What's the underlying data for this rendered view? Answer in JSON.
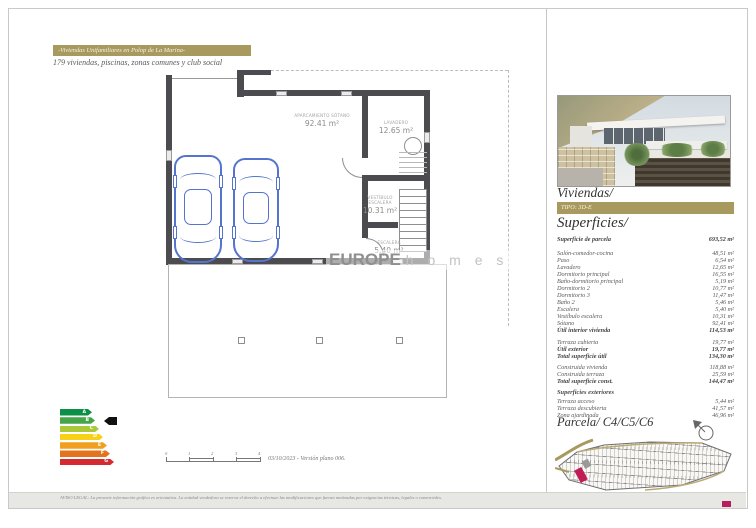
{
  "header": {
    "banner": "-Viviendas Unifamiliares en Polop de La Marina-",
    "subtitle": "179 viviendas, piscinas, zonas comunes y club social"
  },
  "plan": {
    "rooms": [
      {
        "name": "APARCAMIENTO SÓTANO",
        "area": "92.41 m²"
      },
      {
        "name": "LAVADERO",
        "area": "12.65 m²"
      },
      {
        "name": "VESTÍBULO ESCALERA",
        "area": "10.31 m²"
      },
      {
        "name": "ESCALERA",
        "area": "5.40 m²"
      }
    ],
    "watermark_bold": "EUROPE",
    "watermark_light": "h o m e s"
  },
  "panel": {
    "title": "Viviendas/",
    "tipo": "TIPO: 3D-E",
    "superficies_title": "Superficies/",
    "rows": [
      {
        "label": "Superficie de parcela",
        "value": "693,52 m²"
      },
      {
        "label": "Salón-comedor-cocina",
        "value": "48,51 m²"
      },
      {
        "label": "Paso",
        "value": "6,54 m²"
      },
      {
        "label": "Lavadero",
        "value": "12,65 m²"
      },
      {
        "label": "Dormitorio principal",
        "value": "16,55 m²"
      },
      {
        "label": "Baño-dormitorio principal",
        "value": "5,19 m²"
      },
      {
        "label": "Dormitorio 2",
        "value": "10,77 m²"
      },
      {
        "label": "Dormitorio 3",
        "value": "11,47 m²"
      },
      {
        "label": "Baño 2",
        "value": "5,46 m²"
      },
      {
        "label": "Escalera",
        "value": "5,40 m²"
      },
      {
        "label": "Vestíbulo escalera",
        "value": "10,31 m²"
      },
      {
        "label": "Sótano",
        "value": "92,41 m²"
      },
      {
        "label": "Útil interior vivienda",
        "value": "114,53 m²"
      },
      {
        "label": "Terraza cubierta",
        "value": "19,77 m²"
      },
      {
        "label": "Útil exterior",
        "value": "19,77 m²"
      },
      {
        "label": "Total superficie útil",
        "value": "134,30 m²"
      },
      {
        "label": "Construida vivienda",
        "value": "118,88 m²"
      },
      {
        "label": "Construida terraza",
        "value": "25,59 m²"
      },
      {
        "label": "Total superficie const.",
        "value": "144,47 m²"
      },
      {
        "label": "Terraza acceso",
        "value": "5,44 m²"
      },
      {
        "label": "Terraza descubierta",
        "value": "41,57 m²"
      },
      {
        "label": "Zona ajardinada",
        "value": "46,96 m²"
      }
    ],
    "exteriores_heading": "Superficies exteriores",
    "parcela_title": "Parcela/ C4/C5/C6"
  },
  "energy": {
    "selected": "B",
    "grades": [
      {
        "letter": "A",
        "color": "#0c8f47"
      },
      {
        "letter": "B",
        "color": "#44a649"
      },
      {
        "letter": "C",
        "color": "#a9c938"
      },
      {
        "letter": "D",
        "color": "#f7d117"
      },
      {
        "letter": "E",
        "color": "#f0a01e"
      },
      {
        "letter": "F",
        "color": "#e4731f"
      },
      {
        "letter": "G",
        "color": "#d42b33"
      }
    ]
  },
  "scalebar": {
    "ticks": [
      "0",
      "1",
      "2",
      "3",
      "4"
    ]
  },
  "footer": {
    "version": "03/10/2023 - Versión plano 006.",
    "disclaimer": "AVISO LEGAL: La presente información gráfica es orientativa. La entidad vendedora se reserva el derecho a efectuar las modificaciones que fueran motivadas por exigencias técnicas, legales o comerciales."
  },
  "colors": {
    "gold": "#a89a5f",
    "highlight": "#c01d56",
    "wall": "#4b4b50",
    "car": "#5474cd"
  }
}
